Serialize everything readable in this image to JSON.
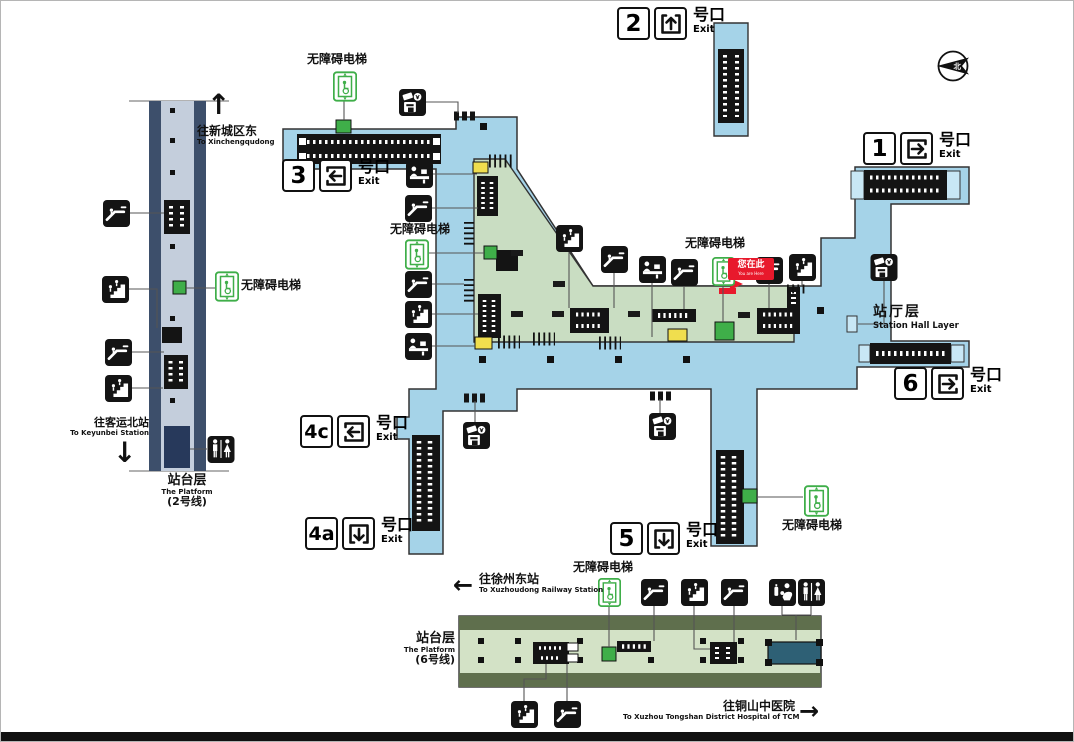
{
  "map": {
    "compass_label": "北",
    "exit_suffix_cn": "号口",
    "exit_suffix_en": "Exit",
    "exits": [
      {
        "id": "2",
        "direction": "up"
      },
      {
        "id": "3",
        "direction": "left"
      },
      {
        "id": "1",
        "direction": "right"
      },
      {
        "id": "6",
        "direction": "right"
      },
      {
        "id": "4c",
        "direction": "left"
      },
      {
        "id": "4a",
        "direction": "down"
      },
      {
        "id": "5",
        "direction": "down"
      }
    ],
    "accessible_elevator": "无障碍电梯",
    "you_are_here": {
      "cn": "您在此",
      "en": "You are Here"
    },
    "station_hall": {
      "cn": "站厅层",
      "en": "Station Hall Layer"
    },
    "platform_line2": {
      "cn": "站台层",
      "en": "The Platform",
      "line": "(2号线)"
    },
    "platform_line6": {
      "cn": "站台层",
      "en": "The Platform",
      "line": "(6号线)"
    },
    "directions": {
      "xincheng": {
        "cn": "往新城区东",
        "en": "To Xinchengqudong",
        "arrow": "↑"
      },
      "keyunbei": {
        "cn": "往客运北站",
        "en": "To Keyunbei Station",
        "arrow": "↓"
      },
      "xuzhoudong": {
        "cn": "往徐州东站",
        "en": "To Xuzhoudong Railway Station",
        "arrow": "←"
      },
      "tongshan": {
        "cn": "往铜山中医院",
        "en": "To Xuzhou Tongshan District Hospital of TCM",
        "arrow": "→"
      }
    },
    "icons": {
      "escalator": "escalator-icon",
      "stairs": "stairs-icon",
      "elevator": "accessible-elevator-icon",
      "service_counter": "service-counter-icon",
      "ticket_machine": "ticket-vending-machine-icon",
      "toilet": "toilet-icon",
      "baby_care": "baby-care-icon",
      "compass": "compass-north-icon"
    },
    "colors": {
      "hall_blue": "#a5d3e8",
      "concourse_green": "#c9ddc2",
      "platform6_green": "#d3e2c6",
      "olive_band": "#5f6f4d",
      "platform2_inner": "#c4cedc",
      "platform2_outer": "#3d4f6b",
      "elevator_green": "#3fae49",
      "gate_yellow": "#f0de4e",
      "marker_red": "#e8192c",
      "toilet_navy": "#27395b",
      "toilet_teal": "#2e6075"
    }
  }
}
